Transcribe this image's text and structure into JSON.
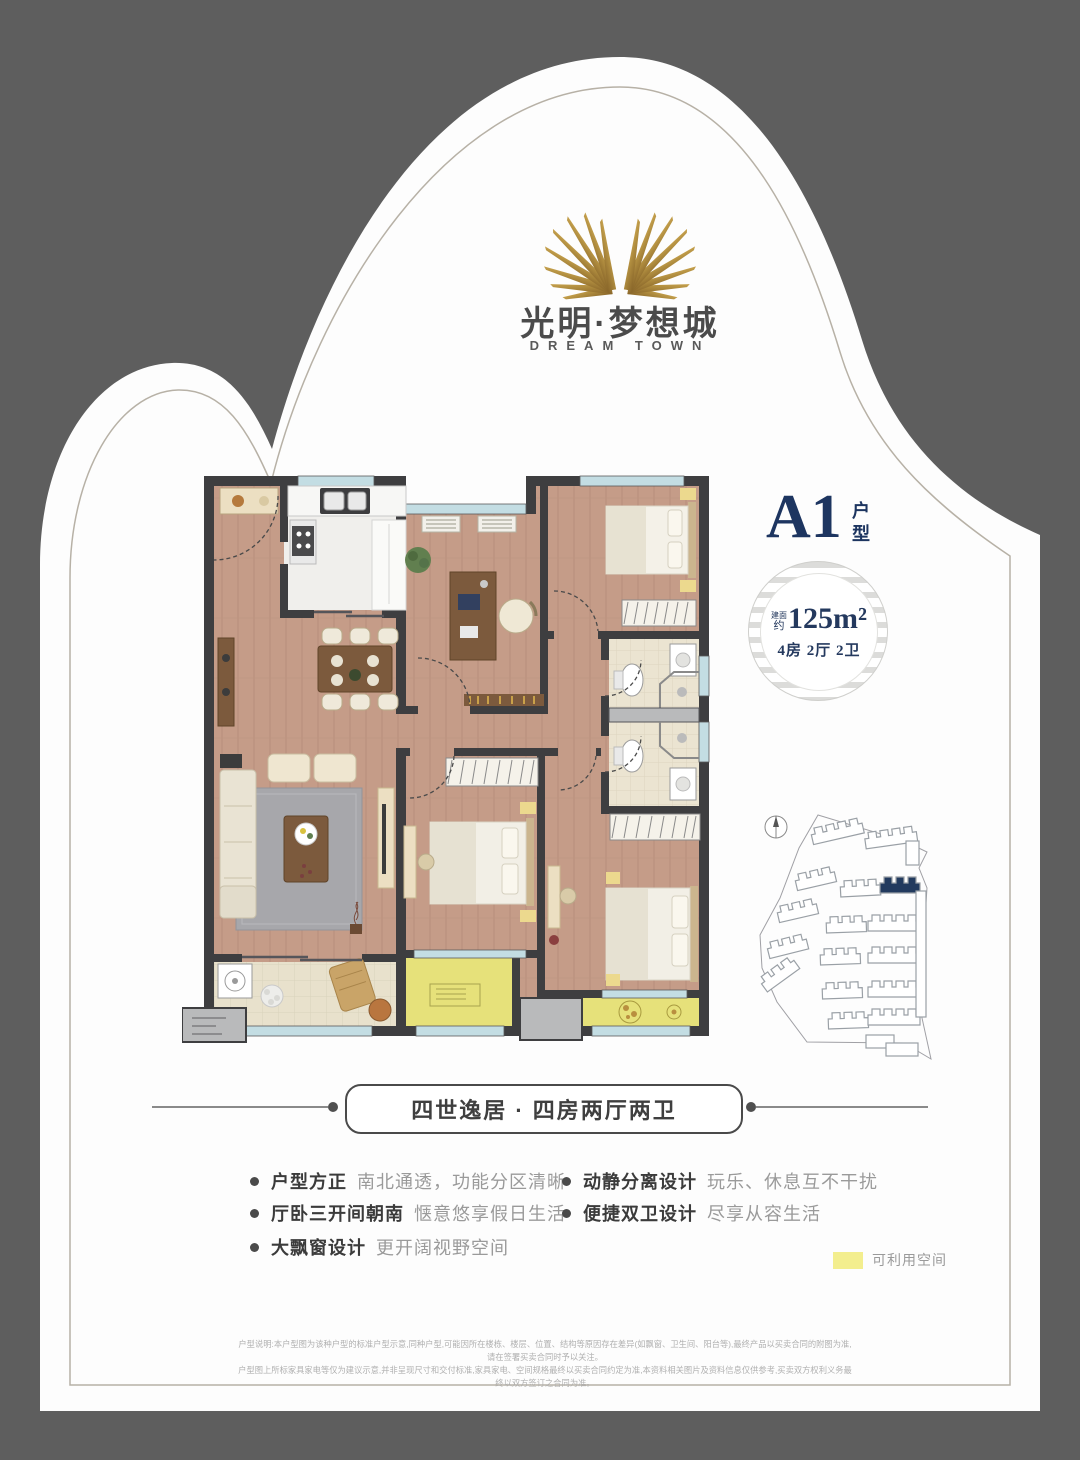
{
  "brand": {
    "name_cn": "光明·梦想城",
    "name_en": "DREAM TOWN"
  },
  "unit": {
    "code": "A1",
    "type_char_1": "户",
    "type_char_2": "型",
    "area_prefix_top": "建面",
    "area_prefix_bottom": "约",
    "area_value": "125m²",
    "layout": "4房 2厅 2卫"
  },
  "banner": {
    "text": "四世逸居 · 四房两厅两卫"
  },
  "features": {
    "left": [
      {
        "title": "户型方正",
        "desc": "南北通透，功能分区清晰"
      },
      {
        "title": "厅卧三开间朝南",
        "desc": "惬意悠享假日生活"
      },
      {
        "title": "大飘窗设计",
        "desc": "更开阔视野空间"
      }
    ],
    "right": [
      {
        "title": "动静分离设计",
        "desc": "玩乐、休息互不干扰"
      },
      {
        "title": "便捷双卫设计",
        "desc": "尽享从容生活"
      }
    ]
  },
  "legend": {
    "label": "可利用空间",
    "swatch_color": "#f3ee8e"
  },
  "disclaimer": {
    "line1": "户型说明:本户型图为该种户型的标准户型示意,同种户型,可能因所在楼栋、楼层、位置、结构等原因存在差异(如飘窗、卫生间、阳台等),最终产品以买卖合同的附图为准,请在签署买卖合同时予以关注。",
    "line2": "户型图上所标家具家电等仅为建议示意,并非呈现尺寸和交付标准,家具家电、空间规格最终以买卖合同约定为准,本资料相关图片及资料信息仅供参考,买卖双方权利义务最终以双方签订之合同为准。"
  },
  "colors": {
    "background": "#5e5e5e",
    "card": "#fdfdfd",
    "accent_navy": "#1d3560",
    "logo_gold": "#b08d3f",
    "usable_space_yellow": "#e6e17a"
  }
}
